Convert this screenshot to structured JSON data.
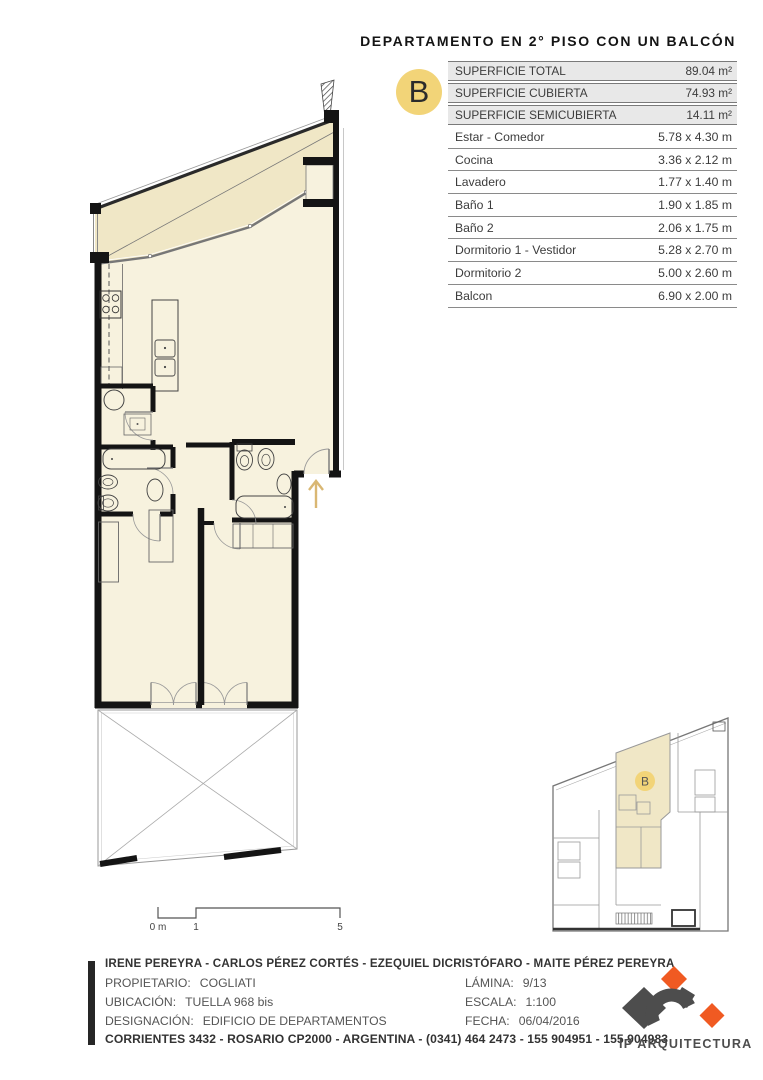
{
  "title": "DEPARTAMENTO EN 2° PISO CON UN BALCÓN",
  "badge": {
    "letter": "B"
  },
  "surfaces": {
    "rows": [
      {
        "label": "SUPERFICIE TOTAL",
        "value": "89.04 m²"
      },
      {
        "label": "SUPERFICIE CUBIERTA",
        "value": "74.93 m²"
      },
      {
        "label": "SUPERFICIE SEMICUBIERTA",
        "value": "14.11 m²"
      }
    ]
  },
  "rooms": {
    "rows": [
      {
        "label": "Estar - Comedor",
        "value": "5.78 x 4.30 m"
      },
      {
        "label": "Cocina",
        "value": "3.36 x 2.12 m"
      },
      {
        "label": "Lavadero",
        "value": "1.77 x 1.40 m"
      },
      {
        "label": "Baño 1",
        "value": "1.90 x 1.85 m"
      },
      {
        "label": "Baño 2",
        "value": "2.06 x 1.75 m"
      },
      {
        "label": "Dormitorio 1 - Vestidor",
        "value": "5.28 x 2.70 m"
      },
      {
        "label": "Dormitorio 2",
        "value": "5.00 x 2.60 m"
      },
      {
        "label": "Balcon",
        "value": "6.90 x 2.00 m"
      }
    ]
  },
  "scale_bar": {
    "zero": "0 m",
    "one": "1",
    "five": "5"
  },
  "key_plan": {
    "badge": "B"
  },
  "footer": {
    "authors": "IRENE PEREYRA - CARLOS PÉREZ CORTÉS - EZEQUIEL DICRISTÓFARO - MAITE PÉREZ PEREYRA",
    "rows": [
      {
        "label": "PROPIETARIO:",
        "value": "COGLIATI",
        "right_label": "LÁMINA:",
        "right_value": "9/13"
      },
      {
        "label": "UBICACIÓN:",
        "value": "TUELLA 968 bis",
        "right_label": "ESCALA:",
        "right_value": "1:100"
      },
      {
        "label": "DESIGNACIÓN:",
        "value": "EDIFICIO DE DEPARTAMENTOS",
        "right_label": "FECHA:",
        "right_value": "06/04/2016"
      }
    ],
    "address": "CORRIENTES 3432 - ROSARIO CP2000 - ARGENTINA - (0341) 464 2473 - 155 904951 - 155 904983"
  },
  "logo": {
    "text": "IP ARQUITECTURA"
  },
  "colors": {
    "accent_yellow": "#f2d478",
    "cream_interior": "#f7f2de",
    "cream_semicovered": "#f0e7c6",
    "logo_orange": "#f05a22",
    "logo_gray": "#4d4d4d",
    "wall_black": "#141414",
    "entry_arrow_tan": "#d9b773"
  }
}
